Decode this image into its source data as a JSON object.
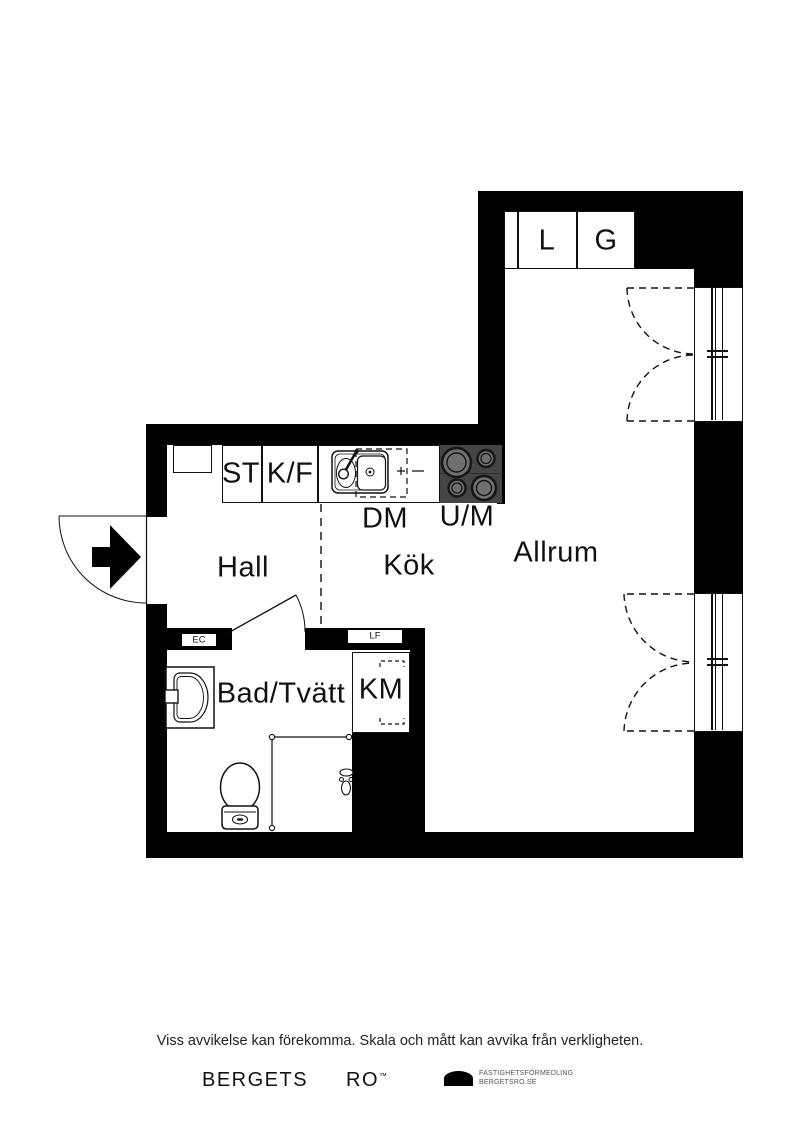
{
  "plan": {
    "rooms": {
      "hall": "Hall",
      "kok": "Kök",
      "allrum": "Allrum",
      "bad": "Bad/Tvätt"
    },
    "fixtures": {
      "l": "L",
      "g": "G",
      "st": "ST",
      "kf": "K/F",
      "dm": "DM",
      "um": "U/M",
      "km": "KM",
      "ec": "EC",
      "lf": "LF"
    },
    "colors": {
      "wall": "#000000",
      "stove_bg": "#454545",
      "burner": "#707070",
      "line": "#111111"
    }
  },
  "footer": {
    "disclaimer": "Viss avvikelse kan förekomma. Skala och mått kan avvika från verkligheten.",
    "brand_1": "BERGETS",
    "brand_2": "RO",
    "brand_mark": "™",
    "logo_line1": "FASTIGHETSFÖRMEDLING",
    "logo_line2": "BERGETSRO.SE"
  }
}
